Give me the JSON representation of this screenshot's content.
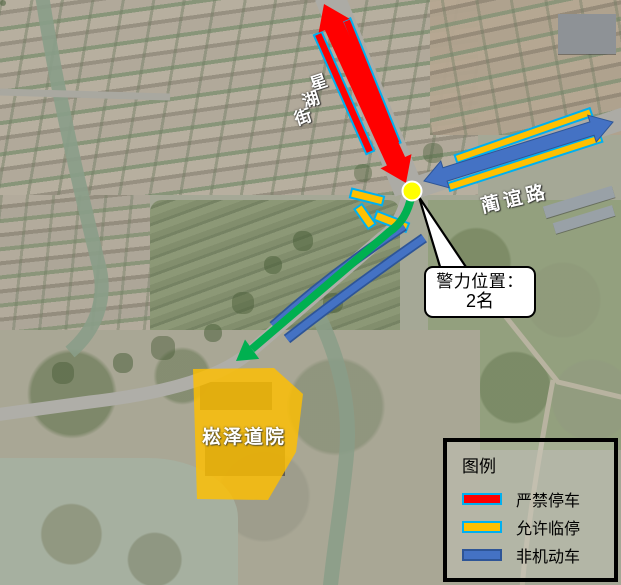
{
  "map": {
    "streets": {
      "xinghu": {
        "name": "星湖街",
        "chars": [
          "星",
          "湖",
          "街"
        ]
      },
      "yi": {
        "name": "蔺谊路"
      }
    },
    "area_label": "崧泽道院",
    "callout": {
      "line1": "警力位置：",
      "line2": "2名"
    },
    "marker": {
      "name": "police-position",
      "color": "#FFFF00"
    }
  },
  "legend": {
    "title": "图例",
    "items": [
      {
        "label": "严禁停车",
        "color": "#FF0000",
        "border": "#00B0F0"
      },
      {
        "label": "允许临停",
        "color": "#FFC000",
        "border": "#00B0F0"
      },
      {
        "label": "非机动车",
        "color": "#4472C4",
        "border": "#2E5597"
      }
    ]
  },
  "colors": {
    "no_parking_red": "#FF0000",
    "temp_parking_gold": "#FFC000",
    "non_motorized_blue": "#4472C4",
    "route_green": "#00B050",
    "cyan_outline": "#00B0F0",
    "marker_yellow": "#FFFF00",
    "temple_area_fill": "#FFC000"
  }
}
